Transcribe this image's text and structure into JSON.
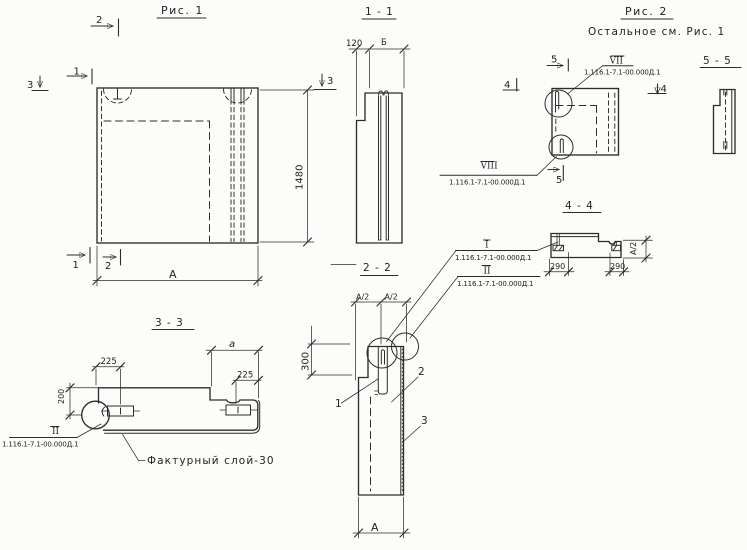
{
  "sheet": {
    "bg": "#fcfcfa",
    "ink": "#2c2c2c"
  },
  "fig1": {
    "title": "Рис. 1",
    "dim_height": "1480",
    "dim_width": "А",
    "marker_cut2_top": "2",
    "marker_cut1_top": "1",
    "marker_cut3_left": "3",
    "marker_cut3_right": "3",
    "marker_cut1_bottom": "1",
    "marker_cut2_bottom": "2"
  },
  "sec11": {
    "title": "1 - 1",
    "dim_thickness": "120",
    "dim_width_b": "Б"
  },
  "sec22": {
    "title": "2 - 2",
    "dim_half_left": "А/2",
    "dim_half_right": "А/2",
    "dim_depth": "300",
    "dim_width": "А",
    "part_loop": "1",
    "part_panel": "2",
    "part_layer": "3",
    "callout_i": {
      "ref": "I",
      "doc": "1.116.1-7.1-00.000Д.1"
    },
    "callout_ii": {
      "ref": "II",
      "doc": "1.116.1-7.1-00.000Д.1"
    }
  },
  "sec33": {
    "title": "3 - 3",
    "dim_225_left": "225",
    "dim_200": "200",
    "dim_a": "а",
    "dim_225_right": "225",
    "callout_ii": {
      "ref": "II",
      "doc": "1.116.1-7.1-00.000Д.1"
    },
    "note": "Фактурный слой-30"
  },
  "sec44": {
    "title": "4 - 4",
    "dim_290_left": "290",
    "dim_290_right": "290",
    "dim_half": "А/2"
  },
  "fig2": {
    "title": "Рис. 2",
    "subtitle": "Остальное см. Рис. 1",
    "marker_cut5_top": "5",
    "marker_cut4_left": "4",
    "marker_cut4_right": "4",
    "marker_cut5_bottom": "5",
    "callout_vii": {
      "ref": "VII",
      "doc": "1.116.1-7.1-00.000Д.1"
    },
    "callout_viii": {
      "ref": "VIII",
      "doc": "1.116.1-7.1-00.000Д.1"
    }
  },
  "sec55": {
    "title": "5 - 5"
  }
}
